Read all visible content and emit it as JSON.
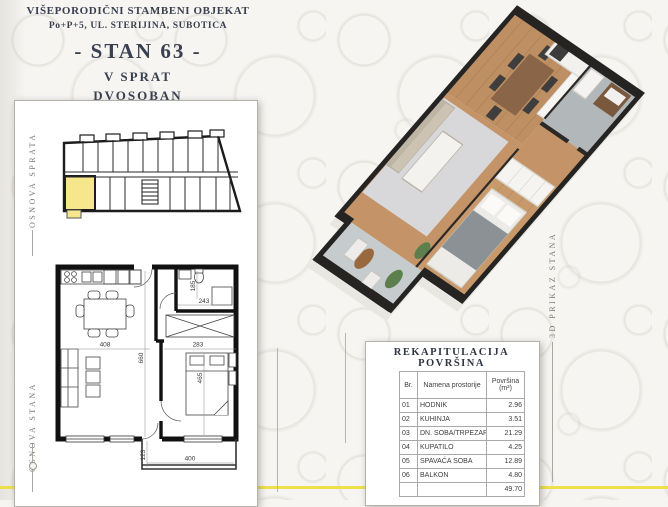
{
  "header": {
    "line1": "VIŠEPORODIČNI STAMBENI OBJEKAT",
    "line2": "Po+P+5, UL. STERIJINA, SUBOTICA",
    "line3": "- STAN 63 -",
    "line4": "V SPRAT",
    "line5": "DVOSOBAN"
  },
  "labels": {
    "floor_plan": "OSNOVA SPRATA",
    "apartment_plan": "OSNOVA STANA",
    "render_3d": "3D PRIKAZ STANA"
  },
  "plan_dimensions": {
    "dining_width": "408",
    "bedroom_width": "283",
    "inner_depth": "660",
    "bed_depth": "465",
    "bath_width": "243",
    "bath_depth": "185",
    "balcony_depth": "123",
    "balcony_width": "400"
  },
  "recap_table": {
    "title": "REKAPITULACIJA POVRŠINA",
    "col_br": "Br.",
    "col_name": "Namena prostorije",
    "col_area_line1": "Površina",
    "col_area_line2": "(m²)",
    "rows": [
      {
        "br": "01",
        "name": "HODNIK",
        "area": "2.96"
      },
      {
        "br": "02",
        "name": "KUHINJA",
        "area": "3.51"
      },
      {
        "br": "03",
        "name": "DN. SOBA/TRPEZARIJA",
        "area": "21.29"
      },
      {
        "br": "04",
        "name": "KUPATILO",
        "area": "4.25"
      },
      {
        "br": "05",
        "name": "SPAVAĆA SOBA",
        "area": "12.89"
      },
      {
        "br": "06",
        "name": "BALKON",
        "area": "4.80"
      }
    ],
    "total": "49.70"
  },
  "colors": {
    "accent_yellow_line": "#eee04a",
    "highlighted_unit": "#f6e78c",
    "header_text": "#39404f"
  }
}
